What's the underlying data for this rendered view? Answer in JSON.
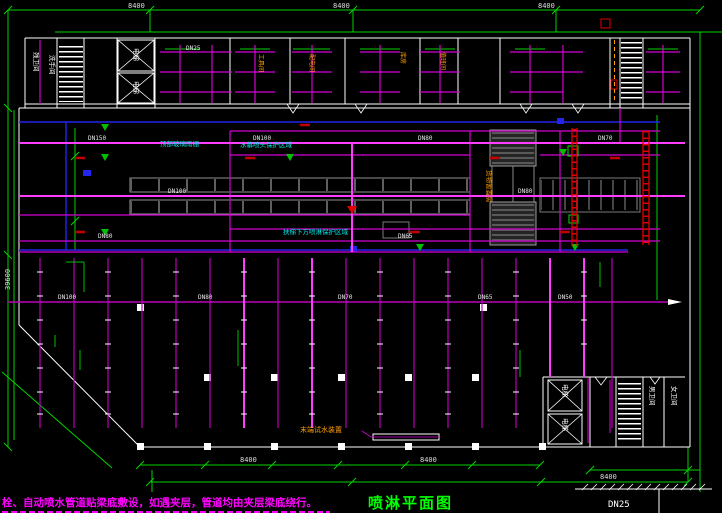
{
  "drawing": {
    "title": "喷淋平面图",
    "note_line1": "栓、自动喷水管道贴梁底敷设，如遇夹层，管道均由夹层梁底绕行。",
    "footer_pipe_label": "DN25"
  },
  "rooms": {
    "toilet_left_1": "残卫间",
    "toilet_left_2": "洗手间",
    "elevator_top_1": "电梯",
    "elevator_top_2": "电梯",
    "elevator_bottom_1": "电梯",
    "elevator_bottom_2": "电梯",
    "toilet_right_1": "男卫间",
    "toilet_right_2": "女卫间"
  },
  "regions": {
    "glass_canopy": "顶部玻璃雨棚",
    "water_curtain_zone": "水幕喷头保护区域",
    "escalator_zone": "扶梯下方喷淋保护区域",
    "goods_room": "货物暂置房",
    "end_test_device": "末端试水装置"
  },
  "bay_labels": [
    "工具间",
    "配电间",
    "库房",
    "值班间"
  ],
  "dn_labels": [
    "DN150",
    "DN100",
    "DN80",
    "DN70",
    "DN100",
    "DN80",
    "DN80",
    "DN65",
    "DN100",
    "DN80",
    "DN70",
    "DN65",
    "DN50",
    "DN25"
  ],
  "dimensions": {
    "top": [
      "8400",
      "8400",
      "8400"
    ],
    "bottom": [
      "8400",
      "8400",
      "8400"
    ],
    "left": "39600"
  },
  "colors": {
    "background": "#000000",
    "dimension_green": "#00d400",
    "pipe_magenta": "#d400d4",
    "pipe_magenta_bright": "#ff3dff",
    "main_blue": "#2424ee",
    "wall_white": "#ffffff",
    "machinery_gray": "#808080",
    "hydrant_red": "#e00000",
    "label_orange": "#ff9f00",
    "label_cyan": "#00e5e5",
    "title_green": "#00ff00"
  }
}
